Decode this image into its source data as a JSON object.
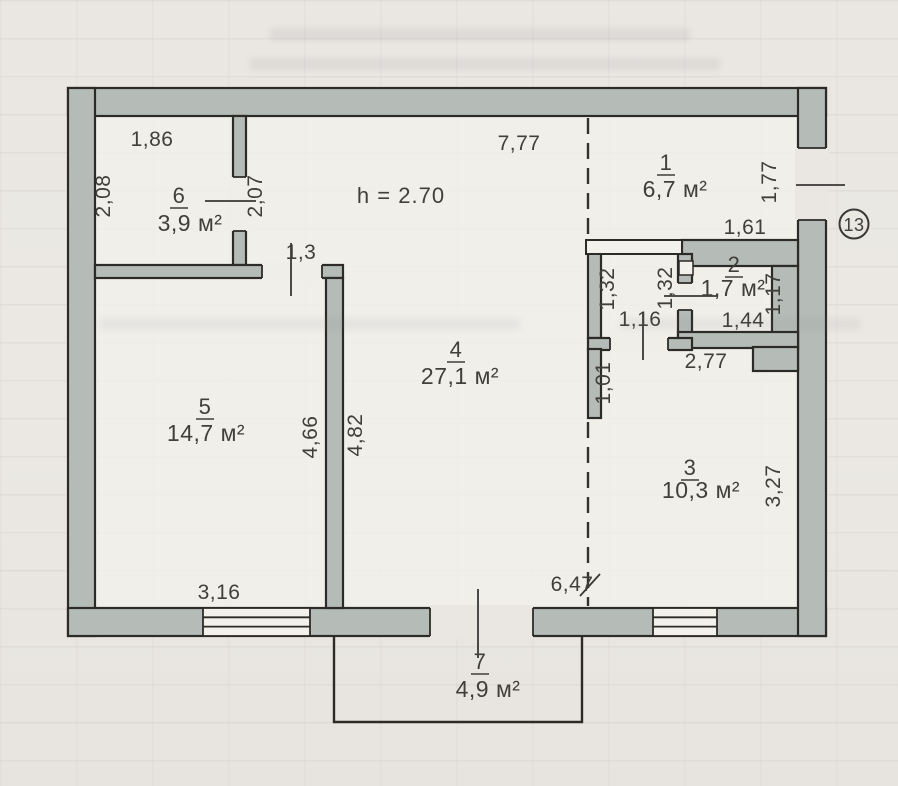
{
  "plan": {
    "ceiling_height_label": "h = 2.70",
    "badge": "13",
    "rooms": {
      "r1": {
        "number": "1",
        "area": "6,7 м²"
      },
      "r2": {
        "number": "2",
        "area": "1,7 м²"
      },
      "r3": {
        "number": "3",
        "area": "10,3 м²"
      },
      "r4": {
        "number": "4",
        "area": "27,1 м²"
      },
      "r5": {
        "number": "5",
        "area": "14,7 м²"
      },
      "r6": {
        "number": "6",
        "area": "3,9 м²"
      },
      "r7": {
        "number": "7",
        "area": "4,9 м²"
      }
    },
    "dims": {
      "d186": "1,86",
      "d208": "2,08",
      "d207": "2,07",
      "d13": "1,3",
      "d777": "7,77",
      "d177": "1,77",
      "d161": "1,61",
      "d132a": "1,32",
      "d132b": "1,32",
      "d116": "1,16",
      "d144": "1,44",
      "d117": "1,17",
      "d101": "1,01",
      "d277": "2,77",
      "d327": "3,27",
      "d466": "4,66",
      "d482": "4,82",
      "d316": "3,16",
      "d647": "6,47"
    }
  }
}
